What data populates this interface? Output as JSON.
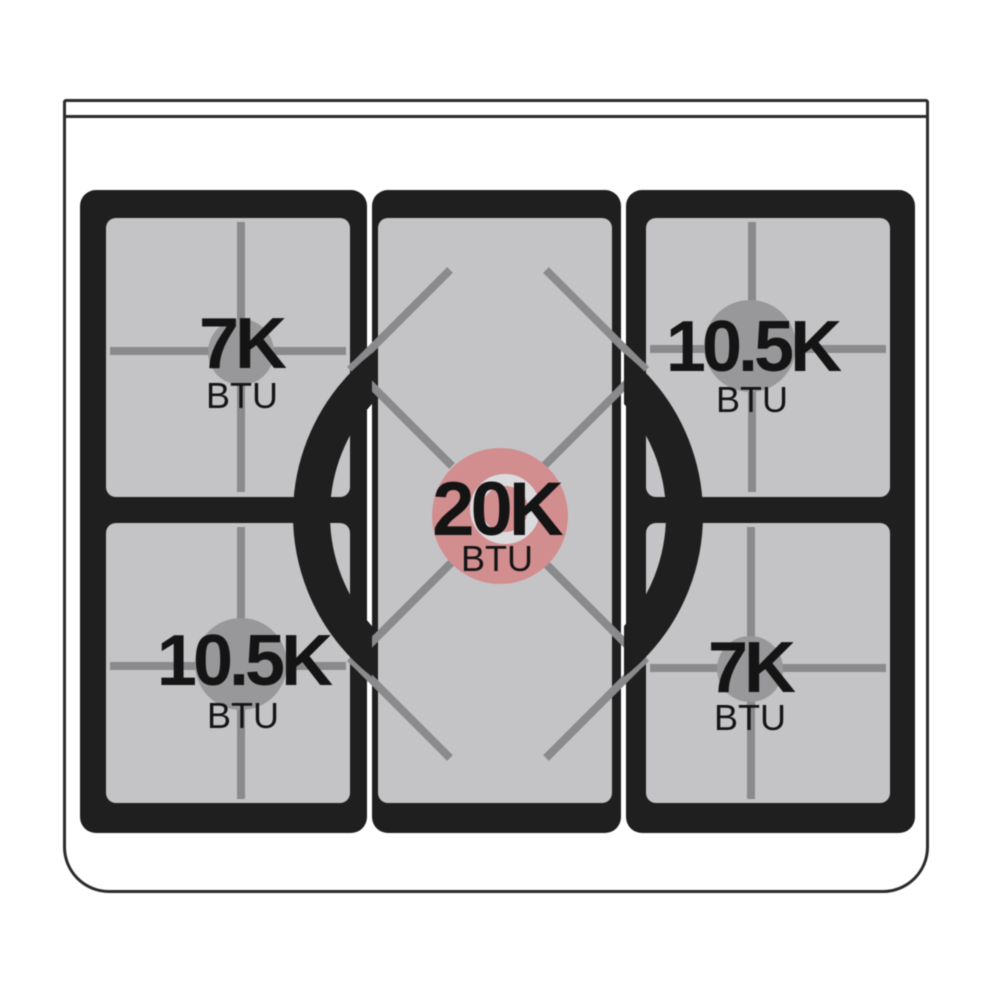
{
  "burners": [
    {
      "position": "top-left",
      "power": "7K",
      "unit": "BTU"
    },
    {
      "position": "top-right",
      "power": "10.5K",
      "unit": "BTU"
    },
    {
      "position": "center",
      "power": "20K",
      "unit": "BTU"
    },
    {
      "position": "bottom-left",
      "power": "10.5K",
      "unit": "BTU"
    },
    {
      "position": "bottom-right",
      "power": "7K",
      "unit": "BTU"
    }
  ],
  "colors": {
    "highlight_burner": "#d28d8f",
    "burner_cap_gray": "#98989a",
    "burner_cap_ring": "#dbdbdd",
    "grate_panel_black": "#1f1f1f",
    "surface_gray": "#c4c4c6",
    "grate_line_gray": "#8a8a8c",
    "body_outline": "#2b2b2b"
  }
}
